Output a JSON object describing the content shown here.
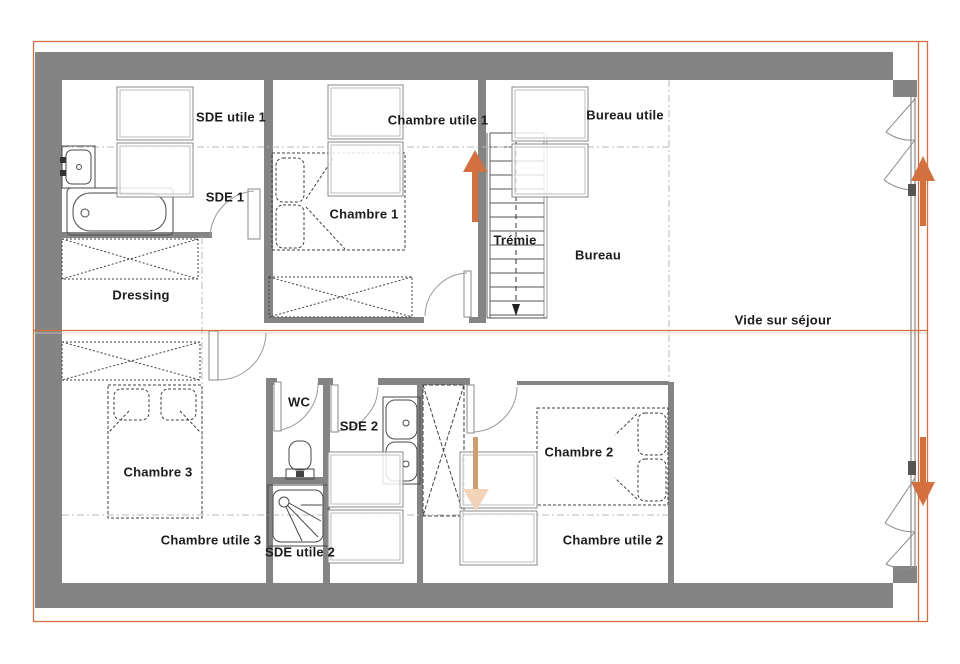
{
  "colors": {
    "accent": "#d2703f",
    "accent_faint": "#f4d4b8",
    "accent_stem": "#cf9d6f",
    "wall": "#848484"
  },
  "labels": {
    "sde_utile_1": "SDE utile 1",
    "chambre_utile_1": "Chambre utile 1",
    "bureau_utile": "Bureau utile",
    "sde_1": "SDE 1",
    "chambre_1": "Chambre 1",
    "tremie": "Trémie",
    "bureau": "Bureau",
    "dressing": "Dressing",
    "vide_sur_sejour": "Vide sur séjour",
    "wc": "WC",
    "sde_2": "SDE 2",
    "chambre_3": "Chambre 3",
    "chambre_2": "Chambre 2",
    "chambre_utile_3": "Chambre utile 3",
    "sde_utile_2": "SDE utile 2",
    "chambre_utile_2": "Chambre utile 2"
  }
}
